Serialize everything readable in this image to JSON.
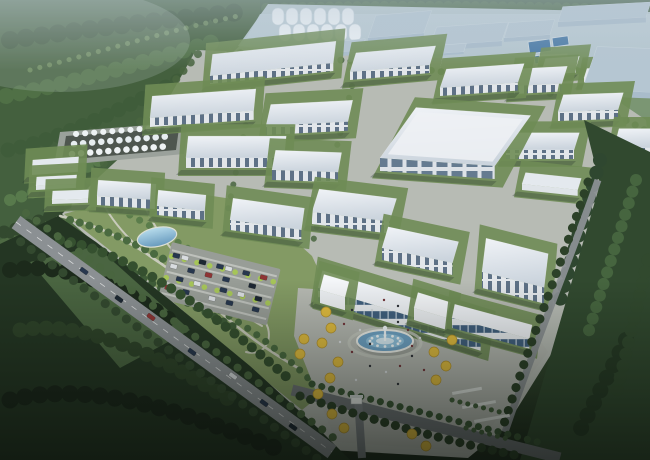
{
  "palette": {
    "hazesky": "#a8bec9",
    "hazebuild": "#b5c6d2",
    "forestdark": "#3a5438",
    "forestmid": "#49653f",
    "forestlight": "#5d7b4c",
    "meadow": "#7c9560",
    "parkgreen": "#839a64",
    "fielddark": "#243623",
    "apron": "#b7bbb4",
    "plaza": "#b5b8b1",
    "roadmain": "#8b9093",
    "roaddark": "#6f7477",
    "roofwhite": "#e7ecf1",
    "facade": "#e2e6ea",
    "win": "#5e7186",
    "glass": "#41607f",
    "lawn": "#6f8c55",
    "hedge": "#44603c",
    "water": "#7fb2d4",
    "poolblue": "#4a7aa6",
    "gold": "#e2bd3f",
    "springtree": "#a6c558",
    "cardark": "#27374e",
    "carred": "#8e2f2f"
  },
  "scene": {
    "regions": [
      "forest-northwest",
      "distant-industrial-zone",
      "grain-silos",
      "water-treatment-pools",
      "factory-campus",
      "tank-farm",
      "central-park",
      "pond",
      "parking-lot",
      "main-avenue",
      "admin-headquarters",
      "fountain-plaza",
      "east-green-belt",
      "south-forest"
    ]
  },
  "campus": {
    "kind_legend": [
      "x",
      "y",
      "w",
      "depth",
      "facade_h",
      "depth_lean",
      "angle_deg",
      "kind"
    ],
    "buildings": [
      [
        558,
        22,
        88,
        16,
        5,
        0.3,
        -3,
        "haze"
      ],
      [
        368,
        38,
        56,
        24,
        5,
        0.33,
        -5,
        "haze"
      ],
      [
        504,
        38,
        46,
        16,
        4,
        0.3,
        -4,
        "haze"
      ],
      [
        430,
        46,
        72,
        20,
        5,
        0.33,
        -4,
        "haze"
      ],
      [
        296,
        56,
        66,
        12,
        4,
        0.3,
        -5,
        "haze"
      ],
      [
        348,
        60,
        116,
        9,
        2,
        0.3,
        -4,
        "haze"
      ],
      [
        538,
        62,
        28,
        7,
        3,
        0.2,
        -3,
        "hshed"
      ],
      [
        542,
        70,
        34,
        12,
        5,
        0.3,
        -4,
        "shed"
      ],
      [
        350,
        72,
        80,
        20,
        8,
        0.3,
        -5,
        "block"
      ],
      [
        534,
        74,
        30,
        7,
        3,
        0.2,
        -2,
        "hshed"
      ],
      [
        210,
        76,
        124,
        22,
        8,
        0.12,
        -6,
        "block"
      ],
      [
        584,
        78,
        28,
        10,
        4,
        0.3,
        -3,
        "shed"
      ],
      [
        514,
        86,
        48,
        18,
        8,
        0.3,
        -3,
        "block"
      ],
      [
        440,
        88,
        78,
        20,
        8,
        0.32,
        -4,
        "block"
      ],
      [
        582,
        90,
        68,
        46,
        6,
        0.33,
        2,
        "haze"
      ],
      [
        558,
        112,
        60,
        18,
        9,
        0.3,
        -2,
        "block"
      ],
      [
        150,
        118,
        104,
        22,
        9,
        0.1,
        -4,
        "block"
      ],
      [
        266,
        126,
        82,
        22,
        9,
        0.22,
        -3,
        "block"
      ],
      [
        614,
        148,
        44,
        20,
        9,
        0.25,
        0,
        "block"
      ],
      [
        506,
        150,
        68,
        18,
        9,
        0.3,
        0,
        "block"
      ],
      [
        380,
        158,
        115,
        62,
        13,
        0.58,
        4,
        "hall"
      ],
      [
        186,
        158,
        98,
        22,
        10,
        0.1,
        0,
        "block"
      ],
      [
        32,
        170,
        46,
        10,
        5,
        0.08,
        -4,
        "shed"
      ],
      [
        272,
        170,
        66,
        20,
        10,
        0.18,
        2,
        "block"
      ],
      [
        522,
        184,
        56,
        12,
        6,
        0.3,
        6,
        "shed"
      ],
      [
        36,
        186,
        40,
        9,
        4,
        0.08,
        -3,
        "shed"
      ],
      [
        97,
        196,
        58,
        16,
        9,
        0.08,
        4,
        "block"
      ],
      [
        52,
        200,
        36,
        9,
        4,
        0.08,
        -2,
        "shed"
      ],
      [
        157,
        206,
        48,
        16,
        9,
        0.08,
        6,
        "block"
      ],
      [
        312,
        212,
        78,
        24,
        12,
        0.3,
        7,
        "block"
      ],
      [
        230,
        220,
        72,
        22,
        10,
        0.14,
        8,
        "block"
      ],
      [
        382,
        248,
        72,
        22,
        12,
        0.28,
        12,
        "block"
      ],
      [
        482,
        272,
        64,
        34,
        16,
        0.12,
        14,
        "block"
      ],
      [
        318,
        288,
        170,
        18,
        13,
        0.25,
        17,
        "admin"
      ],
      [
        320,
        290,
        26,
        16,
        13,
        0.25,
        16,
        "admin2"
      ],
      [
        414,
        308,
        34,
        16,
        12,
        0.25,
        17,
        "admin2"
      ],
      [
        452,
        318,
        80,
        14,
        10,
        0.2,
        15,
        "admin"
      ]
    ]
  },
  "silos": {
    "row1_x": [
      272,
      286,
      300,
      314,
      328,
      342
    ],
    "row1_y": 8,
    "row2_x": [
      279,
      293,
      307,
      321,
      335,
      349
    ],
    "row2_y": 24,
    "w": 12,
    "h": 17,
    "count": 12
  },
  "pools": [
    [
      528,
      42,
      22,
      12
    ],
    [
      552,
      38,
      16,
      9
    ],
    [
      534,
      56,
      14,
      8
    ]
  ],
  "park": {
    "gold_trees": [
      [
        326,
        312
      ],
      [
        331,
        328
      ],
      [
        322,
        343
      ],
      [
        304,
        339
      ],
      [
        300,
        354
      ],
      [
        338,
        362
      ],
      [
        330,
        378
      ],
      [
        318,
        394
      ],
      [
        332,
        414
      ],
      [
        344,
        428
      ],
      [
        434,
        352
      ],
      [
        446,
        366
      ],
      [
        436,
        380
      ],
      [
        452,
        340
      ],
      [
        412,
        434
      ],
      [
        426,
        446
      ]
    ],
    "people": [
      [
        352,
        310
      ],
      [
        344,
        324
      ],
      [
        360,
        330
      ],
      [
        370,
        344
      ],
      [
        352,
        352
      ],
      [
        340,
        342
      ],
      [
        398,
        322
      ],
      [
        408,
        330
      ],
      [
        420,
        338
      ],
      [
        398,
        306
      ],
      [
        384,
        300
      ],
      [
        372,
        310
      ],
      [
        412,
        356
      ],
      [
        400,
        366
      ],
      [
        386,
        372
      ],
      [
        370,
        366
      ],
      [
        424,
        370
      ],
      [
        356,
        380
      ],
      [
        398,
        384
      ],
      [
        412,
        346
      ]
    ],
    "people_colors": [
      "#2e3138",
      "#73343a",
      "#d9dde0"
    ]
  },
  "traffic": {
    "car_colors": [
      "#27374e",
      "#1c2733",
      "#8e3434",
      "#d8dcdf"
    ],
    "avenue_cars": [
      [
        84,
        271,
        36,
        0
      ],
      [
        119,
        299,
        36,
        1
      ],
      [
        151,
        317,
        36,
        2
      ],
      [
        192,
        352,
        36,
        0
      ],
      [
        233,
        376,
        36,
        3
      ],
      [
        264,
        403,
        36,
        0
      ],
      [
        293,
        427,
        36,
        1
      ]
    ]
  },
  "parking": {
    "origin": [
      172,
      242
    ],
    "angle": 14,
    "rows": 5,
    "cars": [
      [
        4,
        10,
        0
      ],
      [
        13,
        10,
        3
      ],
      [
        31,
        10,
        1
      ],
      [
        49,
        10,
        0
      ],
      [
        58,
        10,
        3
      ],
      [
        76,
        10,
        0
      ],
      [
        94,
        10,
        2
      ],
      [
        4,
        21,
        3
      ],
      [
        22,
        21,
        0
      ],
      [
        40,
        21,
        2
      ],
      [
        58,
        21,
        0
      ],
      [
        85,
        21,
        1
      ],
      [
        13,
        32,
        0
      ],
      [
        31,
        32,
        3
      ],
      [
        58,
        32,
        0
      ],
      [
        76,
        32,
        3
      ],
      [
        94,
        32,
        1
      ],
      [
        4,
        43,
        2
      ],
      [
        22,
        43,
        0
      ],
      [
        49,
        43,
        3
      ],
      [
        67,
        43,
        0
      ],
      [
        94,
        43,
        0
      ]
    ]
  },
  "fountain": {
    "cx": 385,
    "cy": 341,
    "rx": 28,
    "ry": 11,
    "jets": 12
  }
}
